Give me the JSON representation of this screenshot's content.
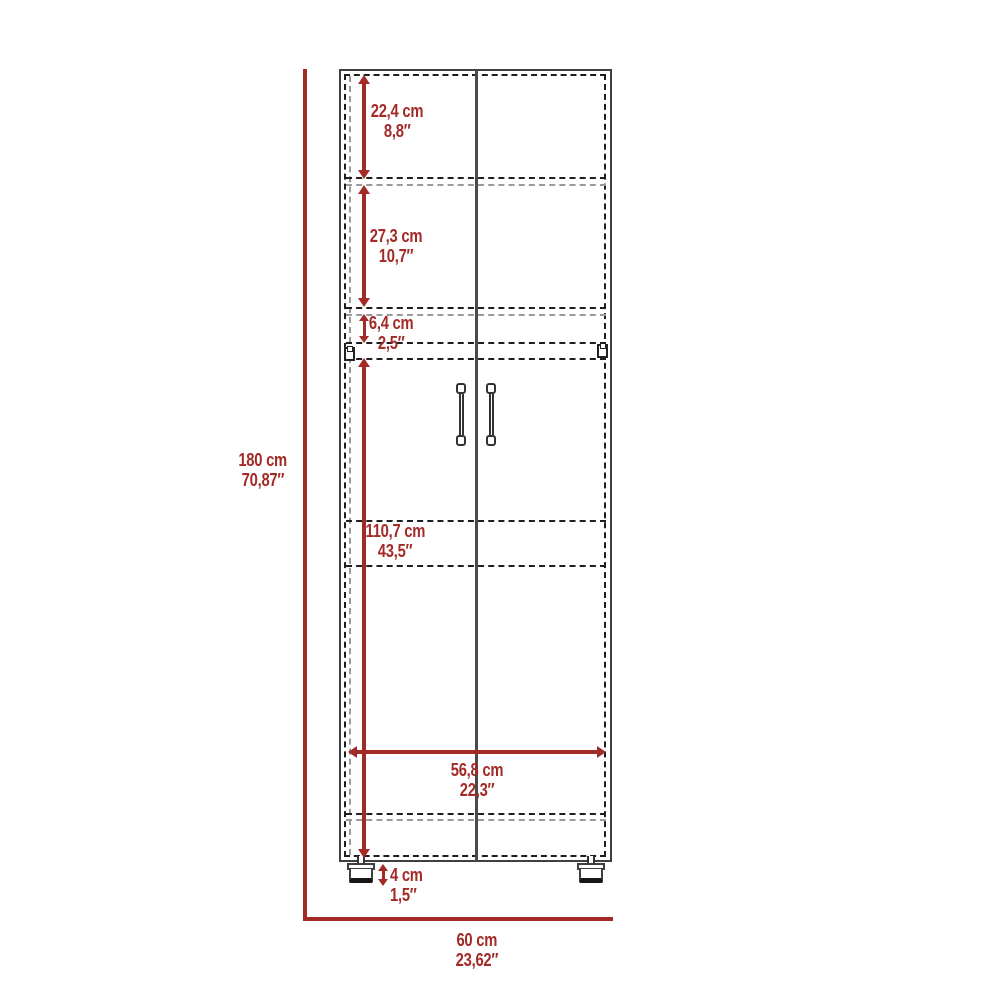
{
  "diagram_title": "tall two-door cabinet dimension drawing",
  "colors": {
    "dimension_red": "#A32B27",
    "cabinet_line": "#3F3F3F",
    "dashed_line": "#1e1e1e",
    "faint_dashed_line": "#9a9a9a"
  },
  "dims": {
    "overall_height": {
      "cm": "180 cm",
      "inch": "70,87″"
    },
    "top_section": {
      "cm": "22,4 cm",
      "inch": "8,8″"
    },
    "second_section": {
      "cm": "27,3 cm",
      "inch": "10,7″"
    },
    "small_gap": {
      "cm": "6,4 cm",
      "inch": "2,5″"
    },
    "door_section": {
      "cm": "110,7 cm",
      "inch": "43,5″"
    },
    "inner_width": {
      "cm": "56,8 cm",
      "inch": "22,3″"
    },
    "leg_height": {
      "cm": "4 cm",
      "inch": "1,5″"
    },
    "overall_width": {
      "cm": "60 cm",
      "inch": "23,62″"
    }
  }
}
